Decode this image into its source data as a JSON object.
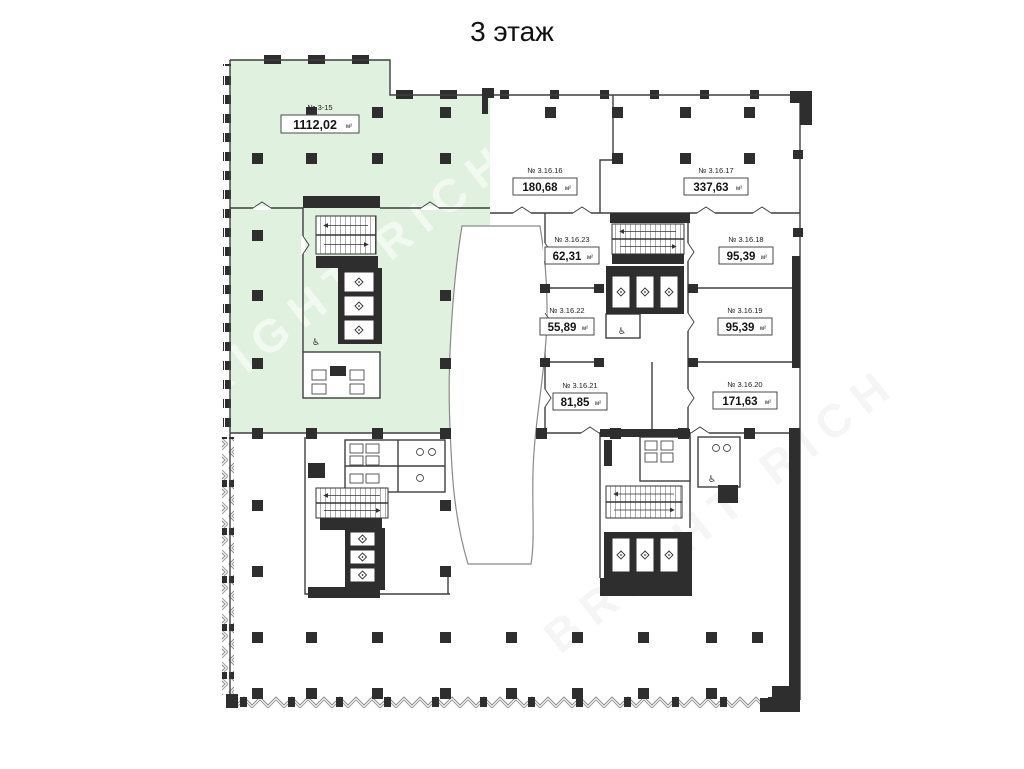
{
  "title": "3 этаж",
  "watermark": "BRIGHT RICH",
  "colors": {
    "highlight": "#e1f1df",
    "wall": "#2e2e2e",
    "line": "#3f3f3f",
    "background": "#ffffff"
  },
  "rooms": [
    {
      "number": "№ 3-15",
      "area": "1112,02",
      "unit": "м²",
      "highlighted": true
    },
    {
      "number": "№ 3.16.16",
      "area": "180,68",
      "unit": "м²",
      "highlighted": false
    },
    {
      "number": "№ 3.16.17",
      "area": "337,63",
      "unit": "м²",
      "highlighted": false
    },
    {
      "number": "№ 3.16.23",
      "area": "62,31",
      "unit": "м²",
      "highlighted": false
    },
    {
      "number": "№ 3.16.18",
      "area": "95,39",
      "unit": "м²",
      "highlighted": false
    },
    {
      "number": "№ 3.16.22",
      "area": "55,89",
      "unit": "м²",
      "highlighted": false
    },
    {
      "number": "№ 3.16.19",
      "area": "95,39",
      "unit": "м²",
      "highlighted": false
    },
    {
      "number": "№ 3.16.21",
      "area": "81,85",
      "unit": "м²",
      "highlighted": false
    },
    {
      "number": "№ 3.16.20",
      "area": "171,63",
      "unit": "м²",
      "highlighted": false
    }
  ]
}
